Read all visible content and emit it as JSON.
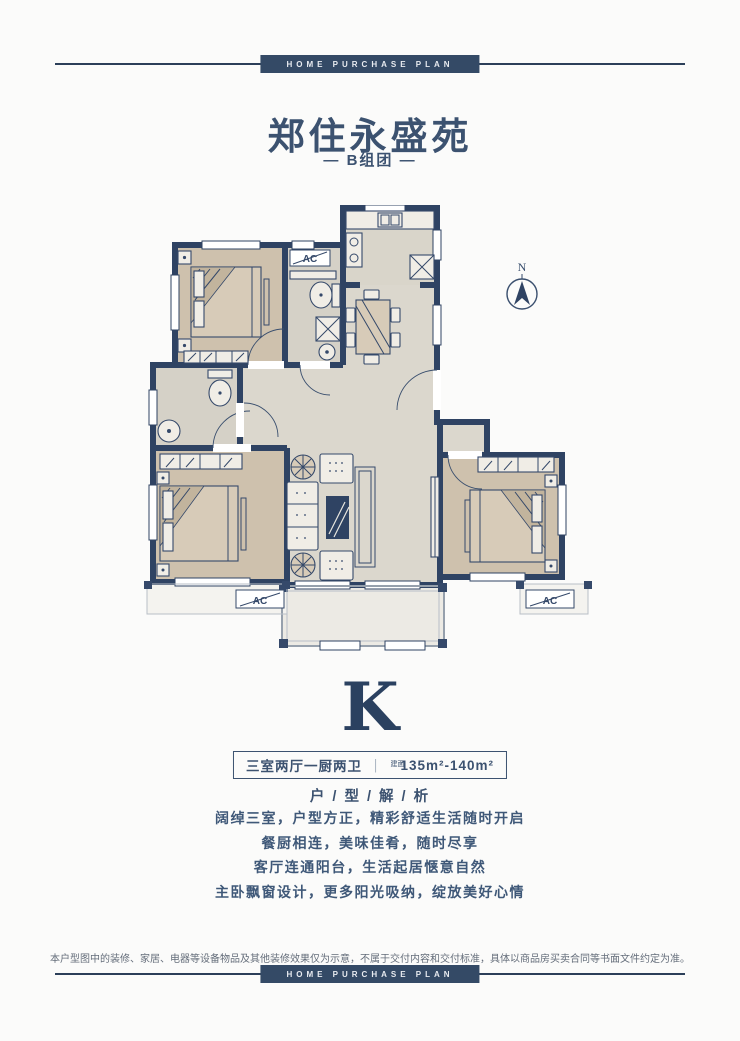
{
  "banner": {
    "top_label": "HOME PURCHASE PLAN",
    "bottom_label": "HOME PURCHASE PLAN"
  },
  "header": {
    "title": "郑住永盛苑",
    "subtitle": "— B组团 —"
  },
  "floorplan": {
    "compass_label": "N",
    "ac_labels": {
      "hall": "AC",
      "left_bay": "AC",
      "right_bay": "AC"
    }
  },
  "unit": {
    "letter": "K",
    "spec": "三室两厅一厨两卫",
    "divider": "｜",
    "area_prefix": "建面",
    "area_range": "135m²-140m²"
  },
  "analysis": {
    "heading": "户 / 型 / 解 / 析",
    "lines": [
      "阔绰三室，户型方正，精彩舒适生活随时开启",
      "餐厨相连，美味佳肴，随时尽享",
      "客厅连通阳台，生活起居惬意自然",
      "主卧飘窗设计，更多阳光吸纳，绽放美好心情"
    ]
  },
  "footer": {
    "disclaimer": "本户型图中的装修、家居、电器等设备物品及其他装修效果仅为示意，不属于交付内容和交付标准，具体以商品房买卖合同等书面文件约定为准。"
  },
  "colors": {
    "navy": "#2f4363",
    "text_navy": "#3c5270",
    "bedroom_floor": "#cec1ad",
    "living_floor": "#dbd7cd",
    "banner_bg": "#344a66"
  }
}
